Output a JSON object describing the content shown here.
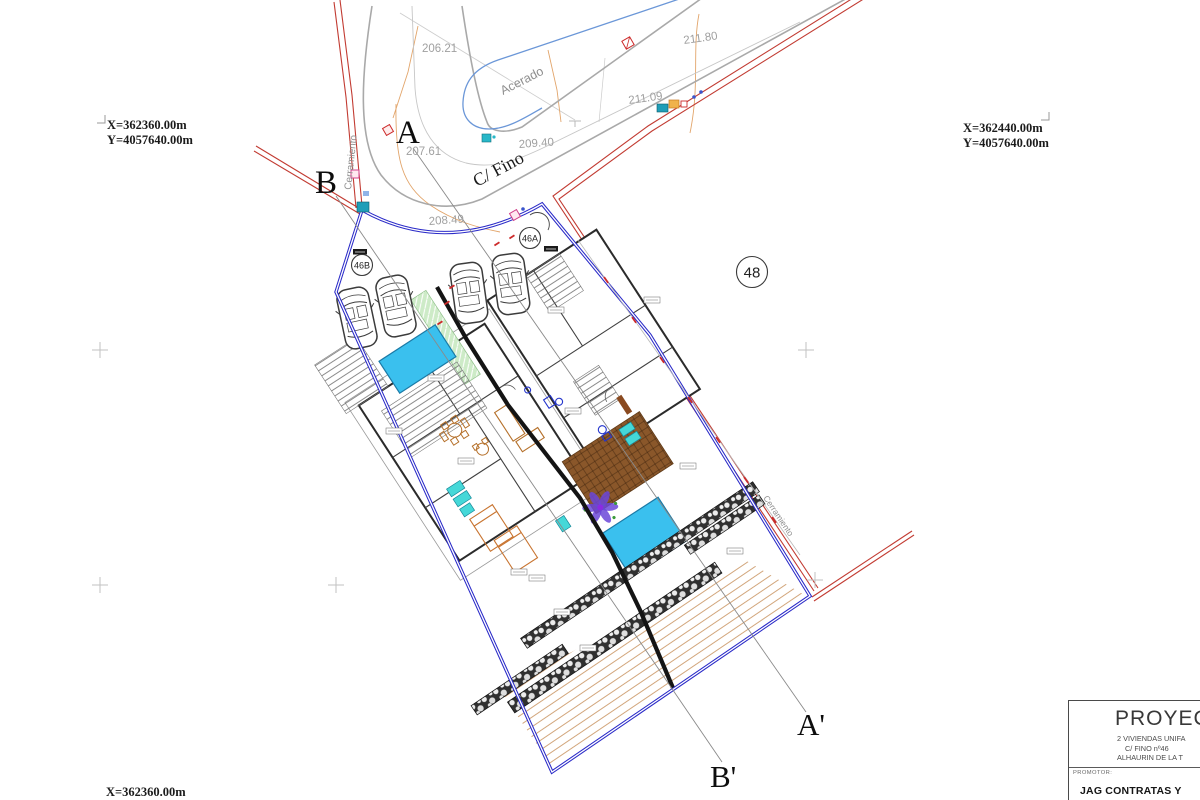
{
  "coordinates": {
    "top_left_x": "X=362360.00m",
    "top_left_y": "Y=4057640.00m",
    "top_right_x": "X=362440.00m",
    "top_right_y": "Y=4057640.00m",
    "bottom_left_x": "X=362360.00m",
    "bottom_left_y": "Y=4057640.00m"
  },
  "section_markers": {
    "a": "A",
    "b": "B",
    "a_prime": "A'",
    "b_prime": "B'"
  },
  "streets": {
    "acerado": "Acerado",
    "c_fino": "C/ Fino",
    "cerramiento_left": "Cerramiento",
    "cerramiento_right": "Cerramiento"
  },
  "spot_elevations": {
    "e_206_21": "206.21",
    "e_207_61": "207.61",
    "e_208_49": "208.49",
    "e_209_40": "209.40",
    "e_211_80": "211.80",
    "e_211_09": "211.09"
  },
  "parcel_labels": {
    "p_46a": "46A",
    "p_46b": "46B",
    "p_48": "48"
  },
  "title_block": {
    "project_label": "PROYECTO",
    "project_line1": "2 VIVIENDAS UNIFA",
    "project_line2": "C/ FINO nº46",
    "project_line3": "ALHAURIN DE LA T",
    "promoter_label": "PROMOTOR:",
    "promoter_name": "JAG CONTRATAS Y"
  },
  "colors": {
    "boundary_blue": "#2a2ac8",
    "fence_red": "#c23b32",
    "pool_cyan": "#3ac0ee",
    "deck_brown": "#8a572a",
    "hatch_green": "#cdebc7",
    "curb_gray": "#a9a9a9",
    "label_gray": "#a0a0a0"
  }
}
